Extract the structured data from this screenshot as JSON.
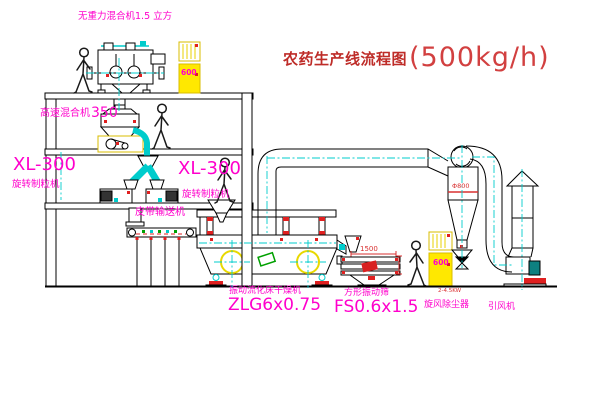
{
  "title": {
    "text": "农药生产线流程图",
    "capacity": "(500kg/h)"
  },
  "equipment_labels": {
    "gravity_mixer": "无重力混合机1.5 立方",
    "high_speed_mixer": "高速混合机",
    "high_speed_mixer_model": "350",
    "granulator_left_model": "XL-300",
    "granulator_left_name": "旋转制粒机",
    "granulator_right_model": "XL-300",
    "granulator_right_name": "旋转制粒机",
    "belt_conveyor": "皮带输送机",
    "fluid_bed_dryer": "振动流化床干燥机",
    "fluid_bed_dryer_model": "ZLG6x0.75",
    "vibrating_screen": "方形振动筛",
    "vibrating_screen_model": "FS0.6x1.5",
    "cyclone": "旋风除尘器",
    "induced_draft_fan": "引风机"
  },
  "annotations": {
    "screen_length_dim": "1500",
    "cyclone_diameter": "Φ800",
    "power_note": "2-4.5KW",
    "cabinet_top_value": "600",
    "cabinet_right_value": "600"
  },
  "colors": {
    "line": "#000000",
    "centerline_cyan": "#00CCCC",
    "label_magenta": "#FF00CC",
    "title_red": "#BE2C28",
    "dimension_red": "#D93030",
    "cabinet_yellow": "#FFE800",
    "accent_green": "#00A000"
  }
}
